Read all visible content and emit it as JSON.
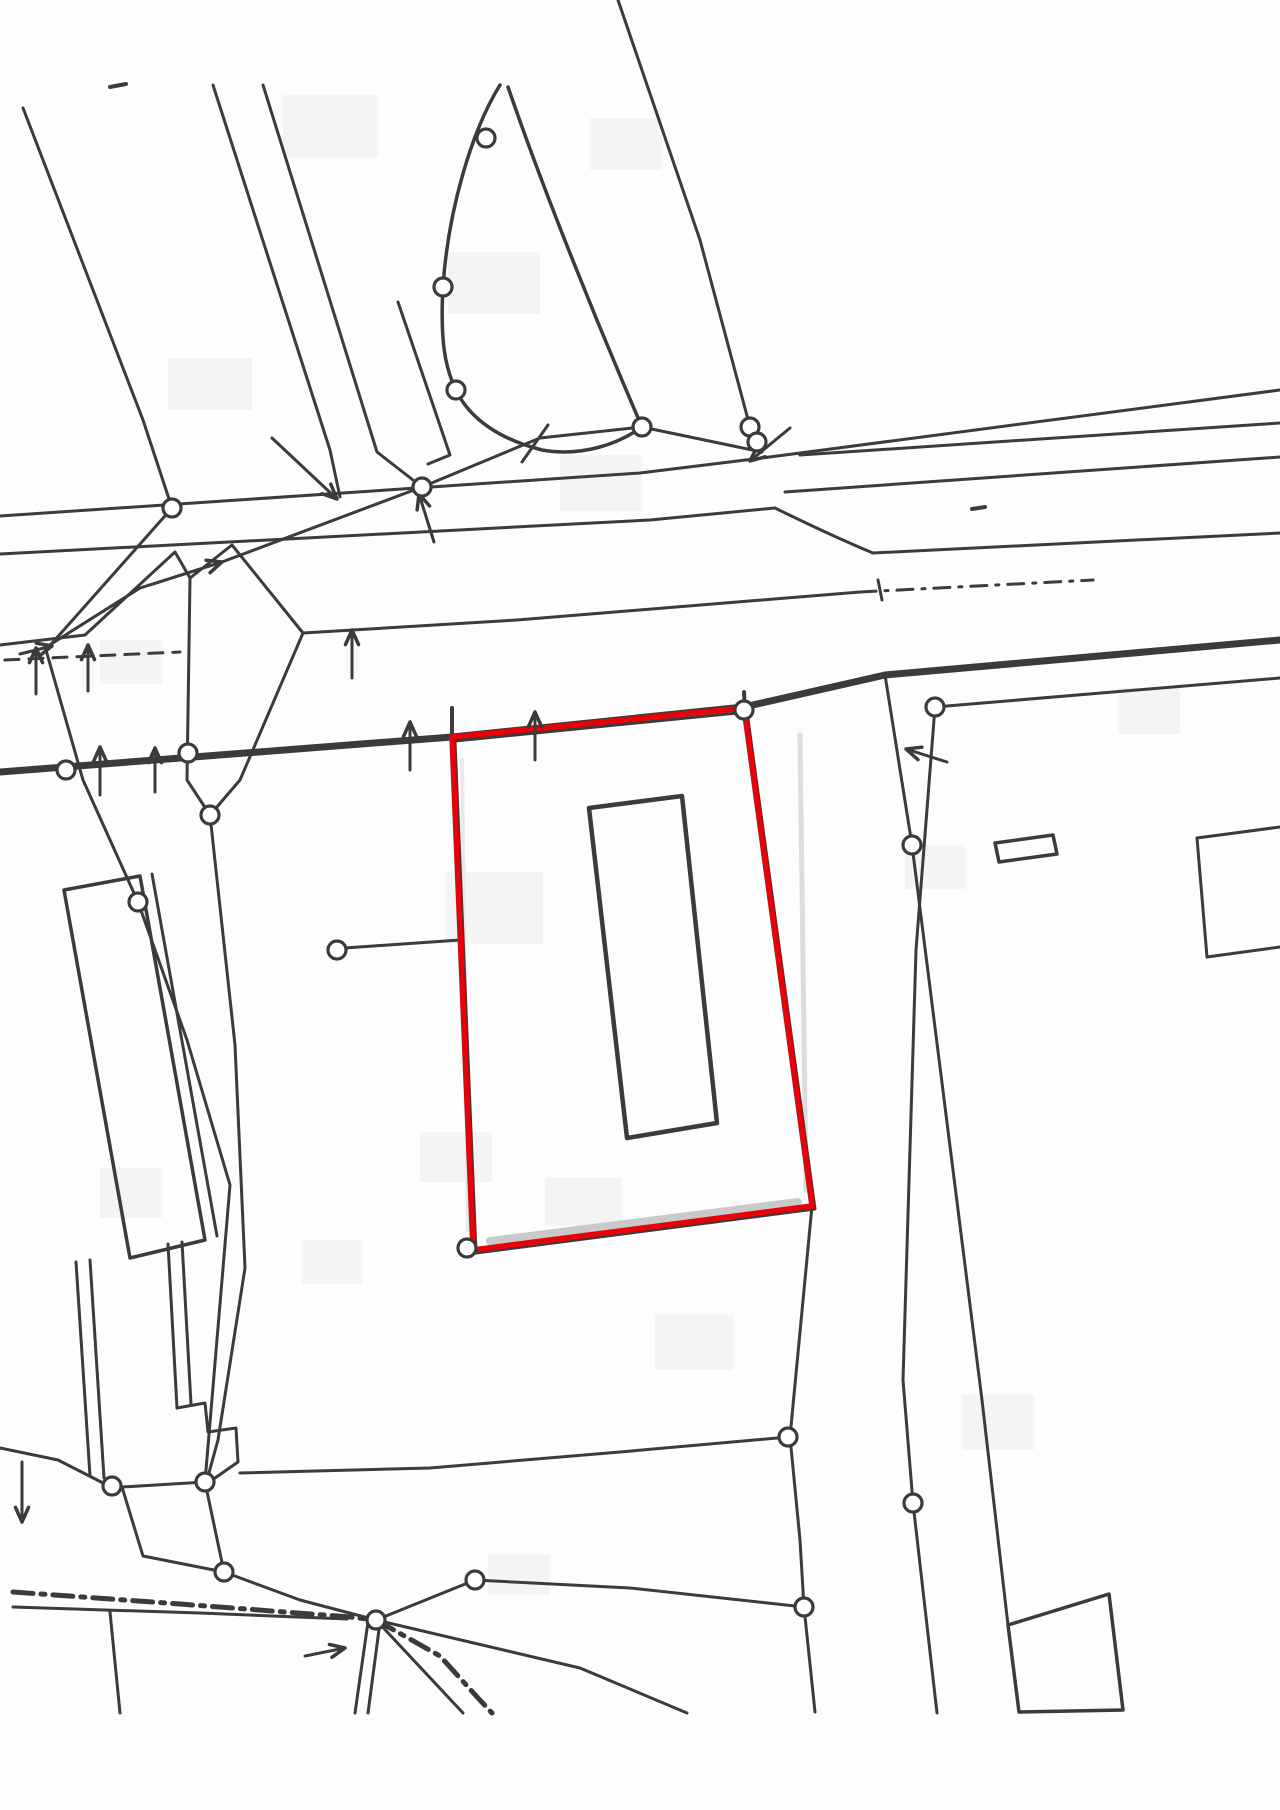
{
  "map": {
    "kind": "scanned-cadastral-plan",
    "width": 1280,
    "height": 1810,
    "colors": {
      "background": "#fdfdfd",
      "ink": "#3b3b3b",
      "highlight": "#e8000b",
      "shadow": "#cccccc",
      "blotch": "#f4f4f4"
    },
    "highlight_parcel": {
      "points": [
        [
          452,
          737
        ],
        [
          744,
          708
        ],
        [
          812,
          1206
        ],
        [
          473,
          1250
        ]
      ],
      "stroke_width": 5.5
    },
    "parcel_under_boundary": {
      "points": [
        [
          455,
          741
        ],
        [
          747,
          712
        ],
        [
          815,
          1209
        ],
        [
          476,
          1253
        ]
      ],
      "stroke_width": 3
    },
    "shadows": [
      {
        "pts": [
          [
            490,
            1241
          ],
          [
            798,
            1202
          ]
        ],
        "w": 8,
        "color": "#c9c9c9"
      },
      {
        "pts": [
          [
            800,
            735
          ],
          [
            806,
            1190
          ]
        ],
        "w": 5,
        "color": "#dddddd"
      },
      {
        "pts": [
          [
            462,
            760
          ],
          [
            468,
            1230
          ]
        ],
        "w": 4,
        "color": "#e9e9e9"
      }
    ],
    "buildings": [
      {
        "name": "inner-building",
        "points": [
          [
            589,
            808
          ],
          [
            682,
            796
          ],
          [
            717,
            1123
          ],
          [
            627,
            1138
          ]
        ],
        "stroke_width": 4.5
      },
      {
        "name": "left-building",
        "points": [
          [
            64,
            890
          ],
          [
            140,
            876
          ],
          [
            205,
            1240
          ],
          [
            130,
            1258
          ]
        ],
        "stroke_width": 3.5
      },
      {
        "name": "bottom-right-structure",
        "points": [
          [
            1008,
            1625
          ],
          [
            1109,
            1594
          ],
          [
            1123,
            1710
          ],
          [
            1019,
            1712
          ]
        ],
        "stroke_width": 3.5
      },
      {
        "name": "small-marker-rect",
        "points": [
          [
            995,
            843
          ],
          [
            1053,
            835
          ],
          [
            1057,
            854
          ],
          [
            999,
            862
          ]
        ],
        "stroke_width": 3.5
      }
    ],
    "lines": [
      {
        "pts": [
          [
            23,
            108
          ],
          [
            143,
            420
          ],
          [
            172,
            508
          ]
        ]
      },
      {
        "pts": [
          [
            213,
            85
          ],
          [
            330,
            450
          ],
          [
            340,
            497
          ]
        ]
      },
      {
        "pts": [
          [
            263,
            85
          ],
          [
            377,
            452
          ],
          [
            422,
            487
          ]
        ]
      },
      {
        "pts": [
          [
            618,
            0
          ],
          [
            700,
            240
          ],
          [
            750,
            427
          ],
          [
            757,
            442
          ],
          [
            762,
            452
          ]
        ]
      },
      {
        "pts": [
          [
            642,
            427
          ],
          [
            762,
            452
          ]
        ]
      },
      {
        "pts": [
          [
            0,
            516
          ],
          [
            640,
            473
          ],
          [
            762,
            458
          ],
          [
            1280,
            390
          ]
        ]
      },
      {
        "pts": [
          [
            800,
            455
          ],
          [
            1280,
            423
          ]
        ]
      },
      {
        "pts": [
          [
            785,
            492
          ],
          [
            1280,
            457
          ]
        ]
      },
      {
        "pts": [
          [
            0,
            554
          ],
          [
            650,
            520
          ],
          [
            775,
            508
          ]
        ]
      },
      {
        "pts": [
          [
            873,
            553
          ],
          [
            1280,
            533
          ]
        ]
      },
      {
        "pts": [
          [
            0,
            645
          ],
          [
            85,
            635
          ],
          [
            175,
            552
          ],
          [
            190,
            578
          ],
          [
            232,
            545
          ],
          [
            303,
            633
          ],
          [
            517,
            620
          ],
          [
            860,
            592
          ]
        ]
      },
      {
        "pts": [
          [
            5,
            660
          ],
          [
            180,
            652
          ]
        ],
        "dash": "14 10"
      },
      {
        "pts": [
          [
            860,
            592
          ],
          [
            1093,
            580
          ]
        ],
        "dash": "16 9 3 9"
      },
      {
        "pts": [
          [
            0,
            772
          ],
          [
            452,
            737
          ],
          [
            744,
            707
          ],
          [
            885,
            675
          ],
          [
            1280,
            640
          ]
        ],
        "w": 7
      },
      {
        "pts": [
          [
            642,
            427
          ],
          [
            540,
            438
          ],
          [
            422,
            487
          ],
          [
            222,
            562
          ],
          [
            140,
            588
          ],
          [
            48,
            646
          ]
        ]
      },
      {
        "pts": [
          [
            172,
            508
          ],
          [
            46,
            650
          ]
        ]
      },
      {
        "pts": [
          [
            46,
            650
          ],
          [
            83,
            780
          ],
          [
            138,
            902
          ],
          [
            187,
            1040
          ],
          [
            230,
            1185
          ],
          [
            205,
            1482
          ]
        ]
      },
      {
        "pts": [
          [
            190,
            578
          ],
          [
            187,
            780
          ],
          [
            210,
            815
          ],
          [
            235,
            1045
          ],
          [
            245,
            1268
          ],
          [
            218,
            1440
          ],
          [
            207,
            1480
          ]
        ]
      },
      {
        "pts": [
          [
            303,
            633
          ],
          [
            240,
            780
          ],
          [
            210,
            815
          ]
        ]
      },
      {
        "pts": [
          [
            345,
            948
          ],
          [
            460,
            940
          ]
        ]
      },
      {
        "pts": [
          [
            452,
            708
          ],
          [
            452,
            740
          ]
        ],
        "w": 4
      },
      {
        "pts": [
          [
            744,
            692
          ],
          [
            745,
            712
          ]
        ],
        "w": 4
      },
      {
        "pts": [
          [
            885,
            675
          ],
          [
            912,
            845
          ],
          [
            982,
            1400
          ],
          [
            1008,
            1625
          ]
        ]
      },
      {
        "pts": [
          [
            935,
            707
          ],
          [
            916,
            950
          ],
          [
            903,
            1380
          ],
          [
            913,
            1503
          ],
          [
            937,
            1713
          ]
        ]
      },
      {
        "pts": [
          [
            935,
            707
          ],
          [
            1280,
            678
          ]
        ]
      },
      {
        "pts": [
          [
            878,
            580
          ],
          [
            882,
            600
          ]
        ]
      },
      {
        "pts": [
          [
            972,
            509
          ],
          [
            985,
            507
          ]
        ],
        "w": 4
      },
      {
        "pts": [
          [
            812,
            1206
          ],
          [
            790,
            1437
          ],
          [
            800,
            1540
          ],
          [
            804,
            1607
          ],
          [
            815,
            1712
          ]
        ]
      },
      {
        "pts": [
          [
            788,
            1437
          ],
          [
            620,
            1452
          ],
          [
            430,
            1468
          ],
          [
            240,
            1473
          ]
        ]
      },
      {
        "pts": [
          [
            376,
            1620
          ],
          [
            475,
            1580
          ],
          [
            630,
            1588
          ],
          [
            804,
            1607
          ]
        ]
      },
      {
        "pts": [
          [
            376,
            1620
          ],
          [
            580,
            1668
          ],
          [
            687,
            1713
          ]
        ]
      },
      {
        "pts": [
          [
            376,
            1620
          ],
          [
            463,
            1713
          ]
        ]
      },
      {
        "pts": [
          [
            0,
            1448
          ],
          [
            58,
            1460
          ],
          [
            107,
            1485
          ],
          [
            122,
            1487
          ],
          [
            205,
            1482
          ]
        ]
      },
      {
        "pts": [
          [
            122,
            1487
          ],
          [
            143,
            1556
          ],
          [
            224,
            1572
          ],
          [
            300,
            1600
          ],
          [
            376,
            1620
          ]
        ]
      },
      {
        "pts": [
          [
            205,
            1482
          ],
          [
            224,
            1572
          ]
        ]
      },
      {
        "pts": [
          [
            13,
            1592
          ],
          [
            180,
            1604
          ],
          [
            350,
            1617
          ],
          [
            376,
            1620
          ]
        ],
        "dash": "20 8 4 8",
        "w": 5
      },
      {
        "pts": [
          [
            376,
            1620
          ],
          [
            440,
            1656
          ],
          [
            478,
            1698
          ],
          [
            492,
            1713
          ]
        ],
        "dash": "20 8 4 8",
        "w": 5
      },
      {
        "pts": [
          [
            13,
            1607
          ],
          [
            200,
            1613
          ],
          [
            347,
            1619
          ]
        ]
      },
      {
        "pts": [
          [
            368,
            1622
          ],
          [
            355,
            1713
          ]
        ]
      },
      {
        "pts": [
          [
            380,
            1622
          ],
          [
            368,
            1713
          ]
        ]
      },
      {
        "pts": [
          [
            110,
            1612
          ],
          [
            120,
            1713
          ]
        ]
      },
      {
        "pts": [
          [
            76,
            1262
          ],
          [
            90,
            1476
          ]
        ]
      },
      {
        "pts": [
          [
            90,
            1260
          ],
          [
            104,
            1478
          ]
        ]
      },
      {
        "pts": [
          [
            168,
            1244
          ],
          [
            177,
            1408
          ]
        ]
      },
      {
        "pts": [
          [
            182,
            1242
          ],
          [
            191,
            1404
          ]
        ]
      },
      {
        "pts": [
          [
            177,
            1408
          ],
          [
            205,
            1403
          ],
          [
            208,
            1432
          ],
          [
            236,
            1428
          ],
          [
            238,
            1462
          ],
          [
            215,
            1478
          ],
          [
            207,
            1480
          ]
        ]
      },
      {
        "pts": [
          [
            152,
            874
          ],
          [
            217,
            1236
          ]
        ]
      },
      {
        "pts": [
          [
            110,
            87
          ],
          [
            126,
            84
          ]
        ],
        "w": 4
      },
      {
        "pts": [
          [
            522,
            462
          ],
          [
            548,
            425
          ]
        ]
      },
      {
        "pts": [
          [
            398,
            302
          ],
          [
            450,
            455
          ],
          [
            428,
            464
          ]
        ]
      },
      {
        "pts": [
          [
            1197,
            838
          ],
          [
            1280,
            827
          ]
        ]
      },
      {
        "pts": [
          [
            1197,
            838
          ],
          [
            1207,
            957
          ]
        ]
      },
      {
        "pts": [
          [
            1207,
            957
          ],
          [
            1280,
            947
          ]
        ]
      }
    ],
    "curves": [
      {
        "d": "M500,85 C472,130 448,210 443,287 C440,340 445,368 456,390 C470,420 502,440 542,450 C582,457 618,444 642,427",
        "w": 3.5
      },
      {
        "d": "M508,87 C545,195 600,330 642,427",
        "w": 3.5
      },
      {
        "d": "M775,508 Q832,536 873,553",
        "w": 3
      }
    ],
    "survey_points": [
      [
        486,
        138
      ],
      [
        443,
        287
      ],
      [
        456,
        390
      ],
      [
        642,
        427
      ],
      [
        750,
        427
      ],
      [
        757,
        442
      ],
      [
        172,
        508
      ],
      [
        422,
        487
      ],
      [
        66,
        770
      ],
      [
        188,
        753
      ],
      [
        210,
        815
      ],
      [
        138,
        902
      ],
      [
        337,
        950
      ],
      [
        467,
        1248
      ],
      [
        744,
        710
      ],
      [
        912,
        845
      ],
      [
        935,
        707
      ],
      [
        112,
        1486
      ],
      [
        205,
        1482
      ],
      [
        224,
        1572
      ],
      [
        376,
        1620
      ],
      [
        475,
        1580
      ],
      [
        788,
        1437
      ],
      [
        804,
        1607
      ],
      [
        913,
        1503
      ]
    ],
    "survey_point_radius": 9,
    "arrows": [
      {
        "tail": [
          100,
          795
        ],
        "tip": [
          100,
          747
        ]
      },
      {
        "tail": [
          155,
          792
        ],
        "tip": [
          155,
          748
        ]
      },
      {
        "tail": [
          36,
          694
        ],
        "tip": [
          36,
          648
        ]
      },
      {
        "tail": [
          88,
          691
        ],
        "tip": [
          88,
          645
        ]
      },
      {
        "tail": [
          352,
          678
        ],
        "tip": [
          352,
          630
        ]
      },
      {
        "tail": [
          410,
          770
        ],
        "tip": [
          410,
          722
        ]
      },
      {
        "tail": [
          535,
          760
        ],
        "tip": [
          535,
          712
        ]
      },
      {
        "tail": [
          150,
          585
        ],
        "tip": [
          222,
          562
        ]
      },
      {
        "tail": [
          272,
          438
        ],
        "tip": [
          337,
          499
        ]
      },
      {
        "tail": [
          434,
          542
        ],
        "tip": [
          419,
          494
        ]
      },
      {
        "tail": [
          790,
          428
        ],
        "tip": [
          750,
          461
        ]
      },
      {
        "tail": [
          947,
          762
        ],
        "tip": [
          906,
          749
        ]
      },
      {
        "tail": [
          305,
          1656
        ],
        "tip": [
          345,
          1648
        ]
      },
      {
        "tail": [
          22,
          1462
        ],
        "tip": [
          22,
          1522
        ]
      },
      {
        "tail": [
          20,
          654
        ],
        "tip": [
          52,
          646
        ]
      }
    ],
    "blotches": [
      [
        283,
        95,
        95,
        62
      ],
      [
        590,
        118,
        72,
        52
      ],
      [
        448,
        252,
        92,
        62
      ],
      [
        560,
        455,
        82,
        56
      ],
      [
        168,
        358,
        84,
        52
      ],
      [
        100,
        640,
        62,
        44
      ],
      [
        445,
        872,
        98,
        72
      ],
      [
        545,
        1178,
        76,
        48
      ],
      [
        420,
        1132,
        72,
        50
      ],
      [
        100,
        1168,
        62,
        50
      ],
      [
        655,
        1315,
        78,
        55
      ],
      [
        962,
        1395,
        72,
        55
      ],
      [
        1118,
        688,
        62,
        46
      ],
      [
        905,
        845,
        60,
        44
      ],
      [
        302,
        1240,
        60,
        44
      ],
      [
        488,
        1555,
        62,
        40
      ]
    ]
  }
}
